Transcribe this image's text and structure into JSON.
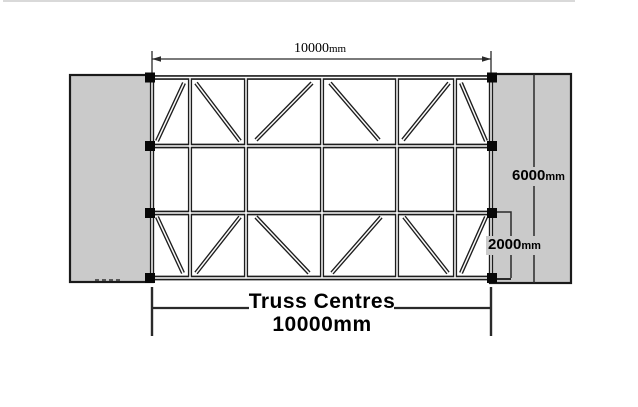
{
  "labels": {
    "top_width": {
      "value": "10000",
      "unit": "mm"
    },
    "right_height": {
      "value": "6000",
      "unit": "mm"
    },
    "right_offset": {
      "value": "2000",
      "unit": "mm"
    },
    "bottom_title": "Truss Centres",
    "bottom_value": "10000mm"
  },
  "colors": {
    "panel_fill": "#cacaca",
    "panel_stroke": "#1a1a1a",
    "member_dark": "#1d1d1d",
    "member_core": "#fbfbfb",
    "dim_line": "#2a2a2a",
    "node_fill": "#070707",
    "text": "#000000",
    "artifact_line": "#c2c2c2"
  },
  "geometry": {
    "canvas": {
      "w": 638,
      "h": 407
    },
    "panels": {
      "left": {
        "x": 70,
        "y": 75,
        "w": 83,
        "h": 207
      },
      "right": {
        "x": 490,
        "y": 74,
        "w": 81,
        "h": 209
      }
    },
    "truss": {
      "left": 152,
      "right": 491,
      "chord_ys": [
        77.5,
        146,
        213,
        278
      ],
      "post_xs": [
        152,
        190,
        246,
        322,
        397,
        455,
        491
      ],
      "diagonals": [
        [
          157,
          141,
          184,
          83
        ],
        [
          196,
          83,
          240,
          141
        ],
        [
          256,
          140,
          312,
          83
        ],
        [
          330,
          83,
          379,
          140
        ],
        [
          403,
          140,
          449,
          83
        ],
        [
          461,
          83,
          486,
          141
        ],
        [
          157,
          217,
          183,
          273
        ],
        [
          196,
          273,
          240,
          217
        ],
        [
          256,
          217,
          309,
          273
        ],
        [
          332,
          273,
          381,
          217
        ],
        [
          404,
          217,
          448,
          273
        ],
        [
          461,
          273,
          486,
          217
        ]
      ],
      "node_left_cx": 150,
      "node_right_cx": 492,
      "node_size": 10
    },
    "dims": {
      "top": {
        "y": 59,
        "x1": 152,
        "x2": 491,
        "ext_y1": 51,
        "ext_y2": 73
      },
      "right_full": {
        "x": 534,
        "y1": 74,
        "y2": 283
      },
      "right_bracket": {
        "x": 511,
        "y1": 212,
        "y2": 278,
        "lead_x": 495,
        "foot_x": 493
      },
      "bottom": {
        "y": 308,
        "x1": 152,
        "x2": 491,
        "tick_y1": 287,
        "tick_y2": 336,
        "gap1": 249,
        "gap2": 394
      }
    },
    "artifact_top_line": {
      "x1": 3,
      "x2": 575,
      "y": 1
    },
    "panel_dash": {
      "x1": 95,
      "x2": 121,
      "y": 280
    }
  }
}
